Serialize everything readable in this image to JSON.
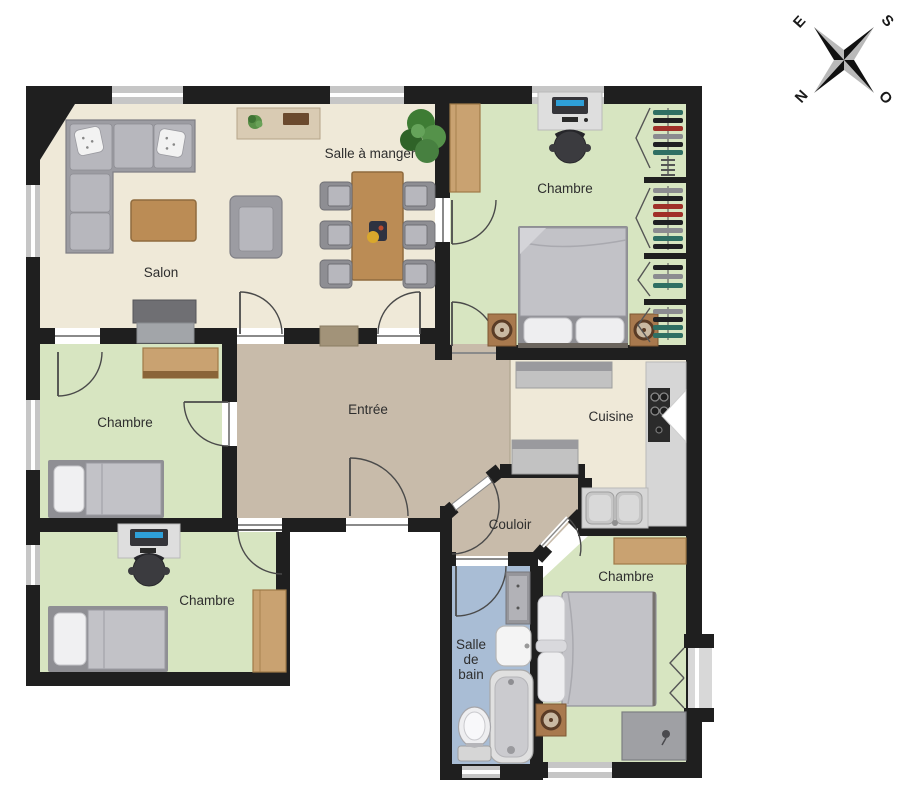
{
  "canvas": {
    "width": 920,
    "height": 800,
    "background": "#ffffff"
  },
  "colors": {
    "wall": "#1f1f1f",
    "floor_living": "#efe9d8",
    "floor_bedroom": "#d7e5c1",
    "floor_hall": "#c8bbaa",
    "floor_bath": "#a9bdd5",
    "wood": "#bb8c55",
    "wood_light": "#c9a271",
    "counter": "#d6d6d6",
    "window": "#c6c6c6",
    "sofa": "#9c9ca2",
    "label_text": "#2e2e2e"
  },
  "rooms": [
    {
      "id": "salon",
      "label": "Salon"
    },
    {
      "id": "salle-a-manger",
      "label": "Salle à manger"
    },
    {
      "id": "chambre-haut-droite",
      "label": "Chambre"
    },
    {
      "id": "chambre-milieu-gauche",
      "label": "Chambre"
    },
    {
      "id": "entree",
      "label": "Entrée"
    },
    {
      "id": "cuisine",
      "label": "Cuisine"
    },
    {
      "id": "couloir",
      "label": "Couloir"
    },
    {
      "id": "chambre-bas-gauche",
      "label": "Chambre"
    },
    {
      "id": "chambre-bas-droite",
      "label": "Chambre"
    },
    {
      "id": "salle-de-bain",
      "lines": [
        "Salle",
        "de",
        "bain"
      ]
    }
  ],
  "compass": {
    "letters": [
      {
        "dir": "est",
        "label": "E"
      },
      {
        "dir": "sud",
        "label": "S"
      },
      {
        "dir": "nord",
        "label": "N"
      },
      {
        "dir": "ouest",
        "label": "O"
      }
    ]
  }
}
